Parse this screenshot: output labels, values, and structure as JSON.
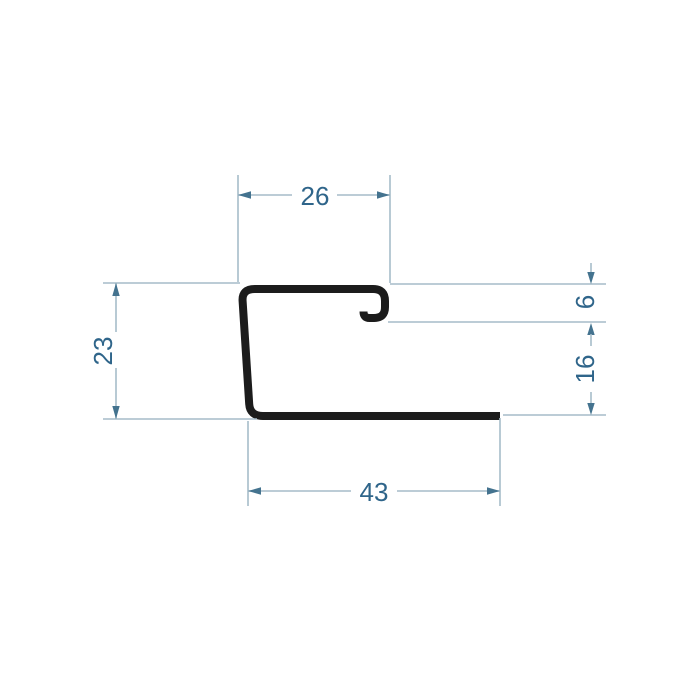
{
  "drawing": {
    "dimensions": {
      "top_width": "26",
      "lip_height": "6",
      "right_height": "16",
      "left_height": "23",
      "bottom_width": "43"
    }
  },
  "colors": {
    "background": "#ffffff",
    "profile": "#1c1c1c",
    "dim_line": "#a6bcc9",
    "dim_arrow": "#44738f",
    "dim_text": "#2f658a"
  }
}
